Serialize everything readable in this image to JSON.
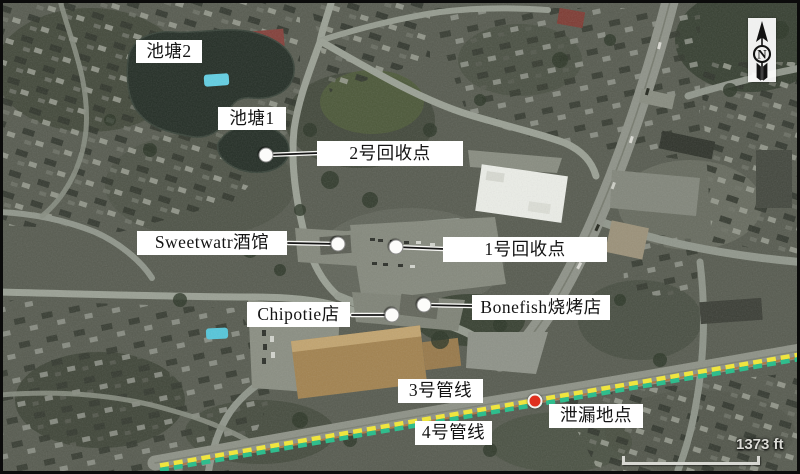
{
  "figure": {
    "type": "annotated-satellite-map",
    "labels": {
      "pond2": "池塘2",
      "pond1": "池塘1",
      "recovery2": "2号回收点",
      "sweetwater": "Sweetwatr酒馆",
      "recovery1": "1号回收点",
      "chipotle": "Chipotie店",
      "bonefish": "Bonefish烧烤店",
      "pipeline3": "3号管线",
      "leak": "泄漏地点",
      "pipeline4": "4号管线"
    },
    "markers": {
      "recovery_point_2": "white-dot",
      "sweetwater_tavern": "white-dot",
      "recovery_point_1": "white-dot",
      "chipotle_store": "white-dot",
      "bonefish_grill": "white-dot",
      "leak_site": "red-dot"
    },
    "scale_bar": {
      "label": "1373 ft"
    },
    "compass": {
      "letter": "N"
    },
    "colors": {
      "pipeline_yellow": "#efe53f",
      "pipeline_green": "#2fbd8d",
      "leak_marker_red": "#df2f1e",
      "label_background": "#ffffff",
      "label_text": "#141414"
    }
  }
}
